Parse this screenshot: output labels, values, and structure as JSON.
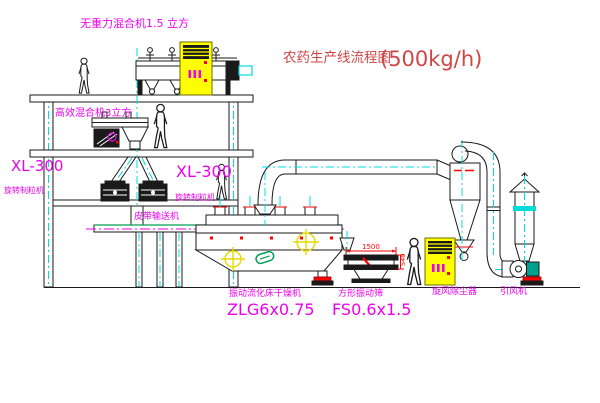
{
  "diagram": {
    "title": "农药生产线流程图",
    "title_capacity": "(500kg/h)"
  },
  "labels": {
    "gravity_free_mixer": "无重力混合机1.5 立方",
    "high_efficiency_mixer": "高效混合机3立方",
    "granulator_left_model": "XL-300",
    "granulator_left_name": "旋转制粒机",
    "granulator_right_model": "XL-300",
    "granulator_right_name": "旋转制粒机",
    "belt_conveyor": "皮带输送机",
    "dryer_name": "振动流化床干燥机",
    "dryer_model": "ZLG6x0.75",
    "sieve_name": "方形振动筛",
    "sieve_model": "FS0.6x1.5",
    "cyclone": "旋风除尘器",
    "fan": "引风机"
  },
  "dimensions": {
    "sieve_length": "1500",
    "sieve_side": "540"
  },
  "colors": {
    "label_magenta": "#ee00ee",
    "title_red": "#cf4646",
    "dimension_red": "#ff0000",
    "centerline_cyan": "#00dcdc",
    "cabinet_yellow": "#ffff00",
    "accent_green": "#00a050",
    "line_dark": "#1a1a1a"
  }
}
